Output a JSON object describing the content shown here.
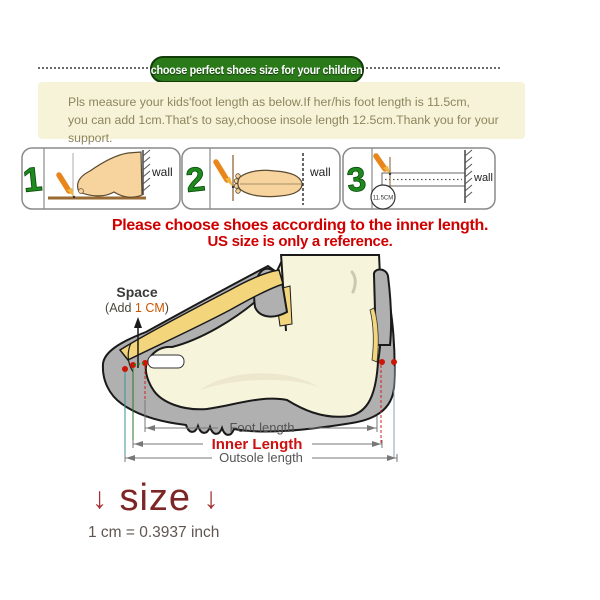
{
  "banner": {
    "label": "choose perfect shoes size for your children"
  },
  "intro": {
    "line1": "Pls measure your kids'foot length as below.If her/his foot length is 11.5cm,",
    "line2": "you can add 1cm.That's to say,choose insole length 12.5cm.Thank you for your support."
  },
  "steps": {
    "one": {
      "number": "1",
      "wall": "wall"
    },
    "two": {
      "number": "2",
      "wall": "wall"
    },
    "three": {
      "number": "3",
      "wall": "wall",
      "ruler_value": "11.5CM"
    }
  },
  "notice": {
    "line1": "Please choose shoes according to the inner length.",
    "line2": "US size is only a reference."
  },
  "diagram": {
    "space_label": "Space",
    "space_note_prefix": "(Add ",
    "space_note_value": "1 CM",
    "space_note_suffix": ")",
    "foot_length_label": "Foot length",
    "inner_length_label": "Inner Length",
    "outsole_length_label": "Outsole length"
  },
  "size_note": {
    "arrow_left": "↓",
    "label": "size",
    "arrow_right": "↓"
  },
  "conversion": "1 cm = 0.3937 inch",
  "colors": {
    "banner_green": "#2a7a1a",
    "notice_red": "#d00000",
    "inner_length_red": "#cc1111",
    "pencil_orange": "#e8861c",
    "shoe_gray": "#b0b0b0",
    "foot_cream": "#f7f4dc",
    "insole_yellow": "#f3d67c",
    "marker_red": "#cc1505"
  }
}
